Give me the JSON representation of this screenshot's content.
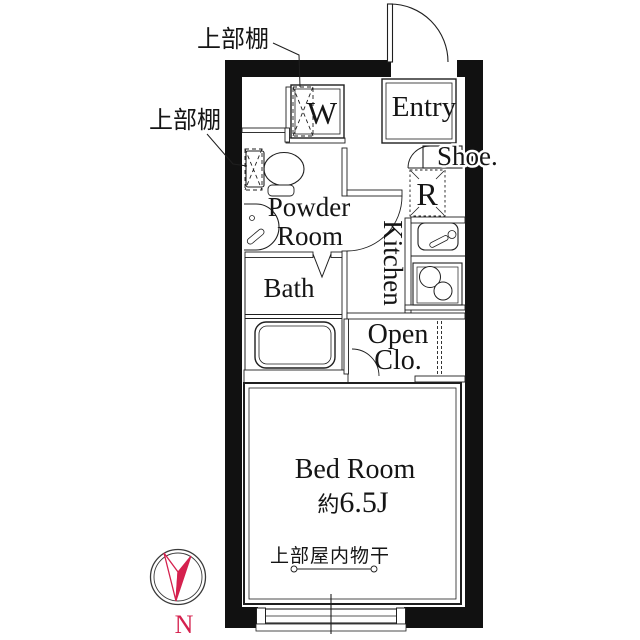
{
  "plan": {
    "type": "floor-plan",
    "rooms": {
      "entry": "Entry",
      "shoe_cabinet": "Shoe.",
      "washing_machine": "W",
      "refrigerator": "R",
      "powder_room_line1": "Powder",
      "powder_room_line2": "Room",
      "kitchen": "Kitchen",
      "bath": "Bath",
      "open_closet_line1": "Open",
      "open_closet_line2": "Clo.",
      "bedroom": "Bed Room",
      "bedroom_size_prefix": "約",
      "bedroom_size_value": "6.5J"
    },
    "annotations": {
      "upper_shelf_top": "上部棚",
      "upper_shelf_side": "上部棚",
      "overhead_indoor_drying": "上部屋内物干",
      "compass_north": "N"
    },
    "colors": {
      "wall": "#111111",
      "line": "#1f1f1f",
      "accent": "#d5214e",
      "background": "#ffffff"
    }
  }
}
